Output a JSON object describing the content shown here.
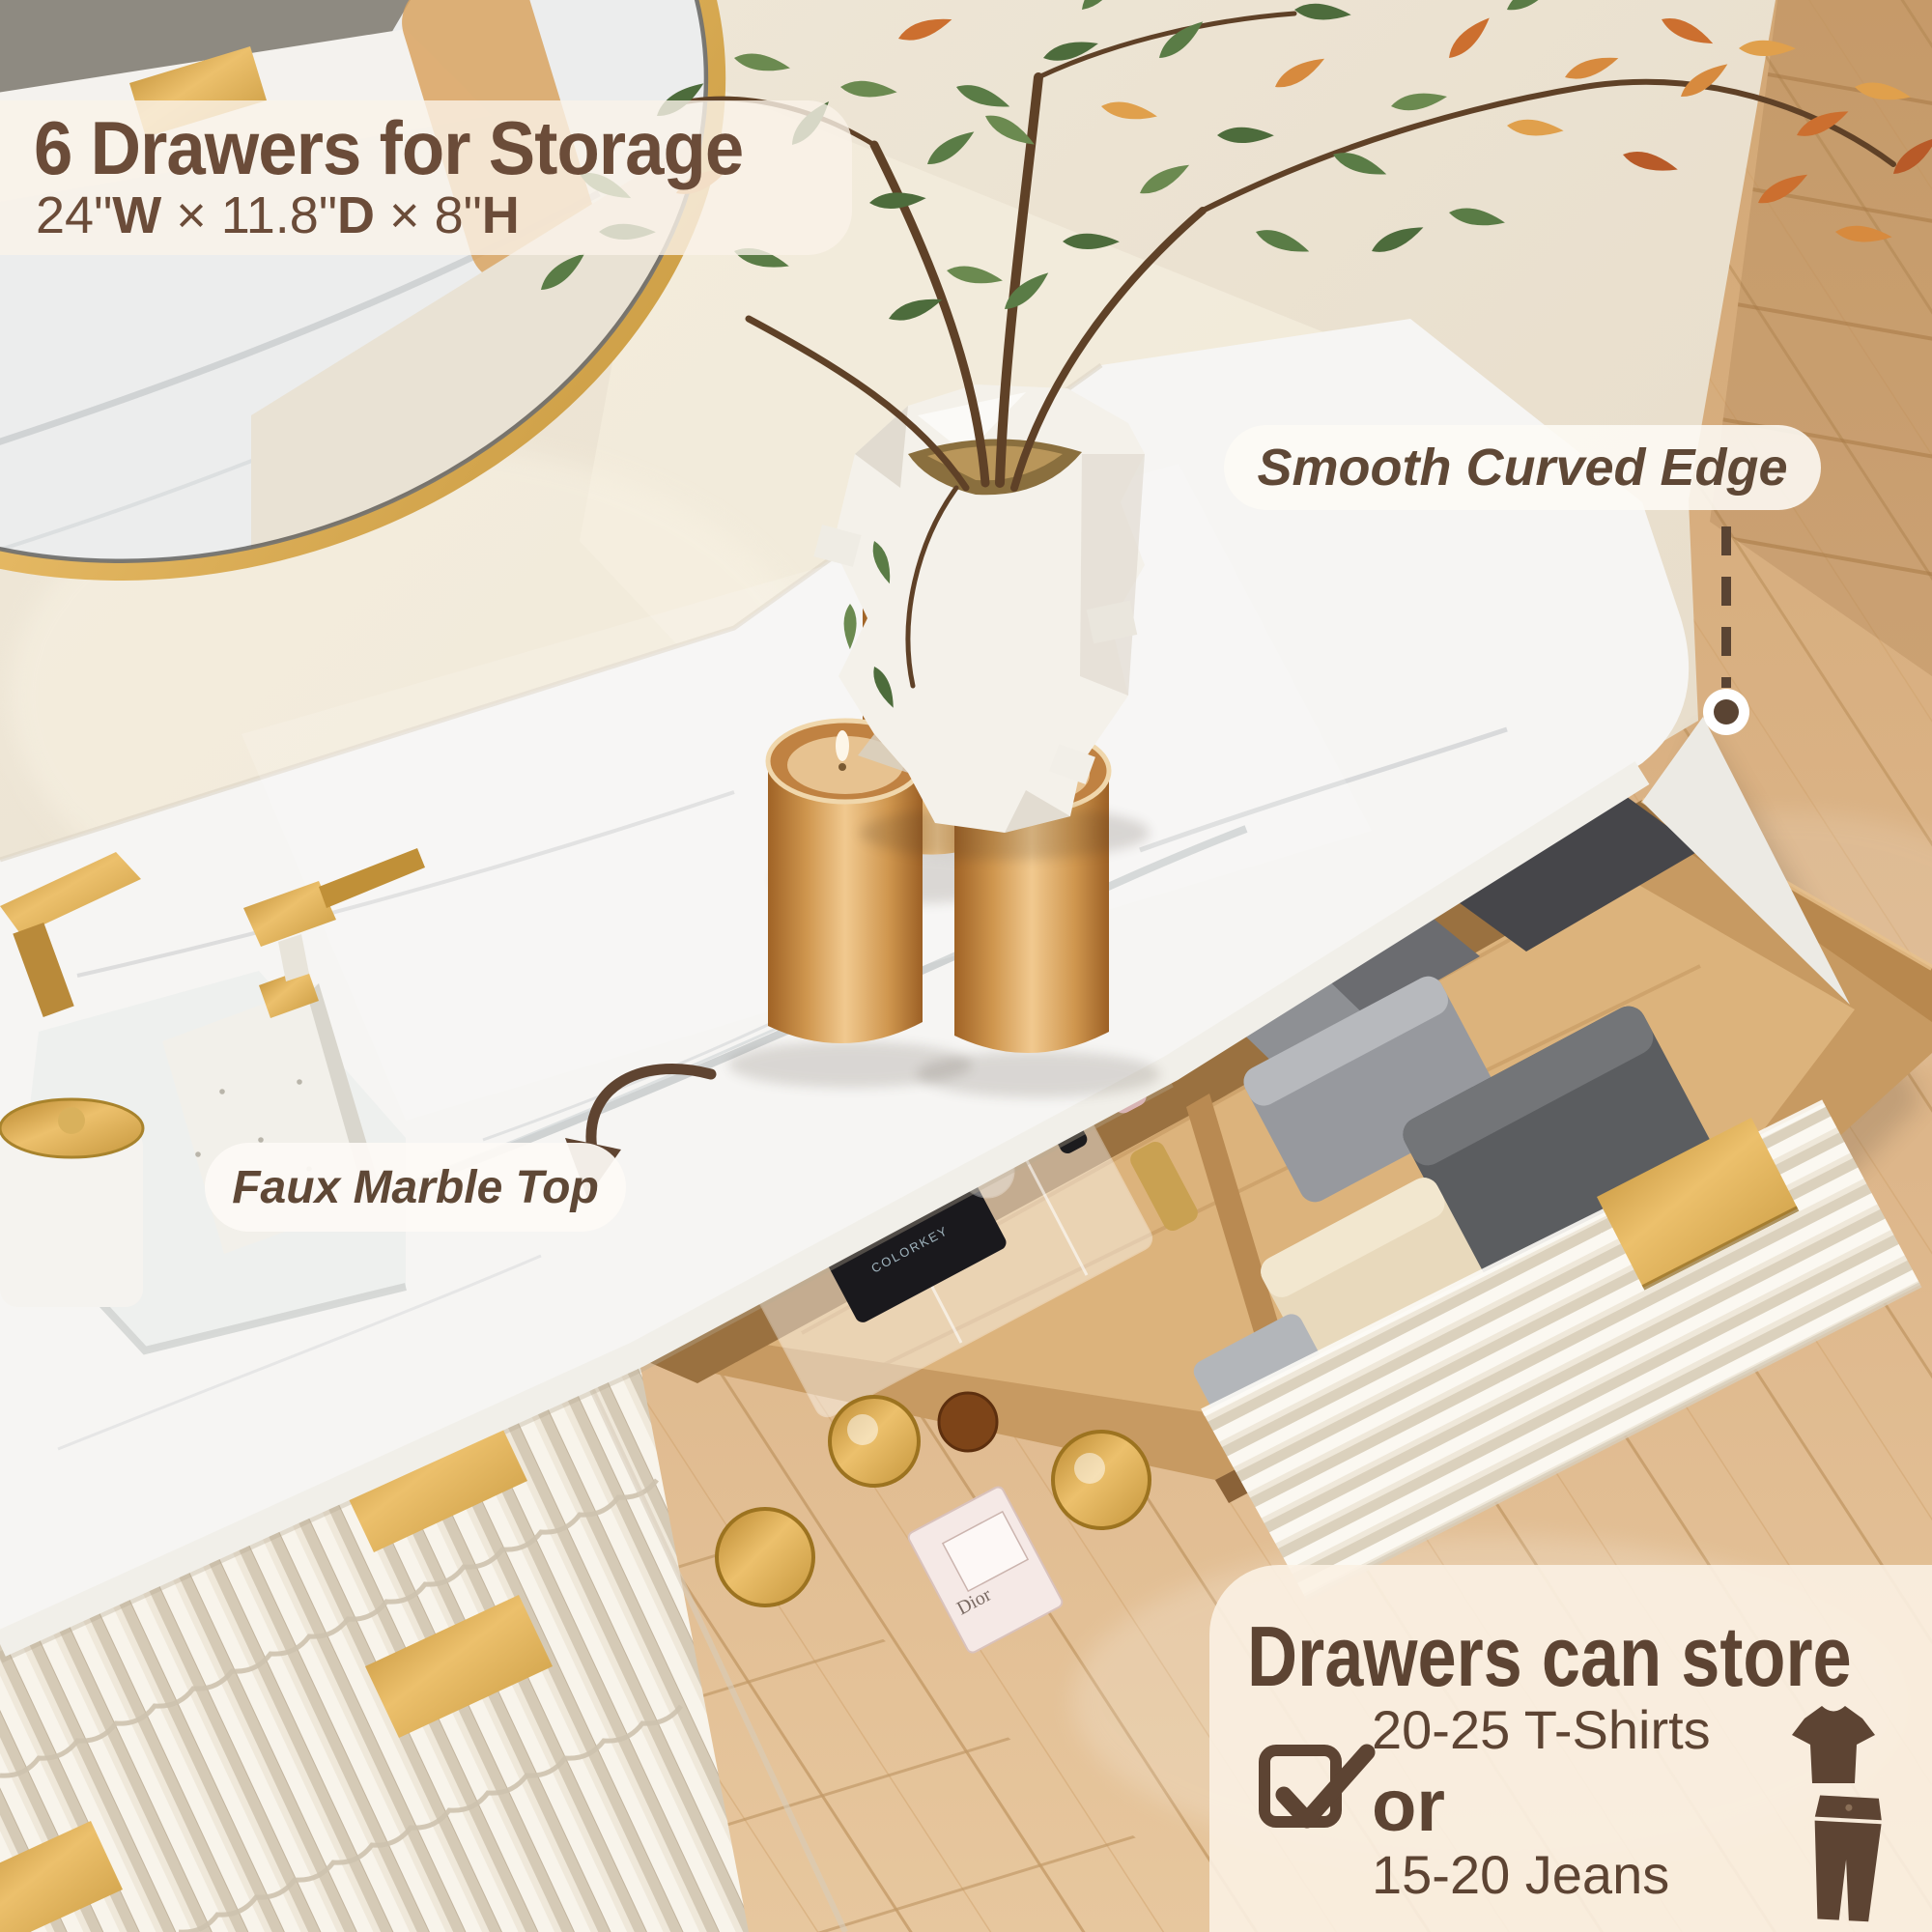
{
  "colors": {
    "text_brown": "#5d4433",
    "title_brown": "#6b4c39",
    "accent_gold": "#c9973d",
    "panel_cream": "rgba(251,241,227,0.90)",
    "pill_white": "rgba(253,250,245,0.9)",
    "wood_floor": "#dcb386",
    "marble_white": "#f6f5f3"
  },
  "title_panel": {
    "title": "6 Drawers for Storage",
    "dimensions_text": "24\"W × 11.8\"D × 8\"H",
    "dimensions_parts": [
      {
        "text": "24\"",
        "bold": false
      },
      {
        "text": "W",
        "bold": true
      },
      {
        "text": " × ",
        "bold": false
      },
      {
        "text": "11.8\"",
        "bold": false
      },
      {
        "text": "D",
        "bold": true
      },
      {
        "text": " × ",
        "bold": false
      },
      {
        "text": "8\"",
        "bold": false
      },
      {
        "text": "H",
        "bold": true
      }
    ]
  },
  "callouts": {
    "edge": {
      "label": "Smooth Curved Edge"
    },
    "marble": {
      "label": "Faux Marble Top"
    }
  },
  "storage_panel": {
    "title": "Drawers can store",
    "options": [
      {
        "label": "20-25 T-Shirts",
        "icon": "tshirt-icon"
      },
      {
        "label": "15-20 Jeans",
        "icon": "jeans-icon"
      }
    ],
    "conjunction": "or",
    "check_icon": "checkbox-checked-icon"
  },
  "scene_labels": {
    "palette_brand": "Spark",
    "palette_sub": "COLORKEY",
    "perfume_brand": "Dior"
  }
}
